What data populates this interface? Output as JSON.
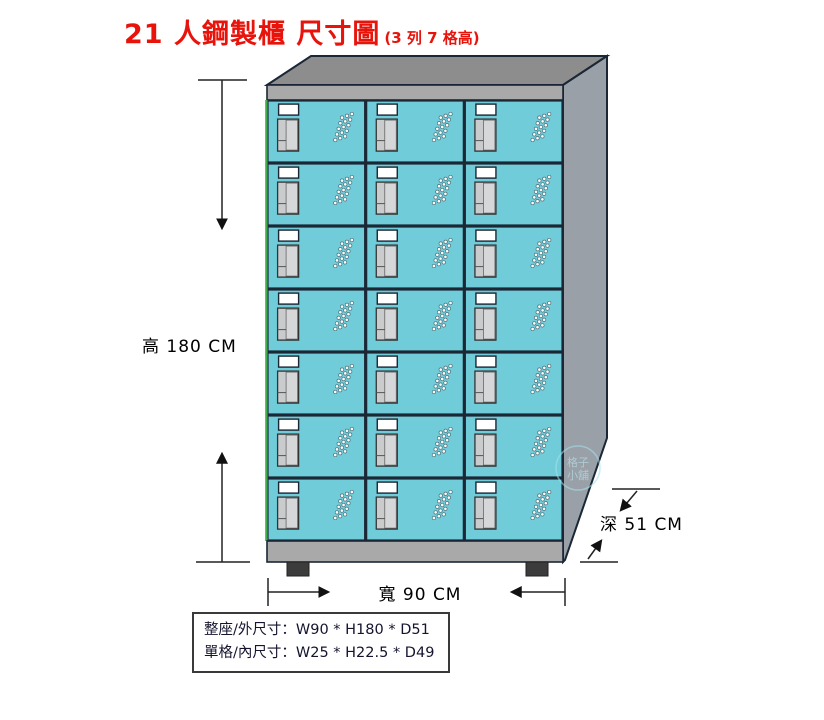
{
  "title": {
    "main": "21 人鋼製櫃 尺寸圖",
    "sub": "(3 列 7 格高)"
  },
  "dimensions": {
    "height_label": "高 180 CM",
    "width_label": "寬 90 CM",
    "depth_label": "深 51 CM"
  },
  "spec_box": {
    "line1": "整座/外尺寸：W90 * H180 * D51",
    "line2": "單格/內尺寸：W25 * H22.5 * D49"
  },
  "locker": {
    "rows": 7,
    "columns": 3,
    "total_compartments": 21
  },
  "watermark": {
    "line1": "格子",
    "line2": "小舖"
  },
  "colors": {
    "title_red": "#e8140c",
    "door_teal": "#6fccd8",
    "frame_gray": "#a9a9a9",
    "top_gray": "#8d8d8d",
    "side_gray": "#9aa0a8",
    "outline_navy": "#1b2735",
    "foot_dark": "#3c3c3c",
    "edge_green": "#3fae4a",
    "plate_white": "#ffffff",
    "handle_gray": "#c9cbcd"
  }
}
